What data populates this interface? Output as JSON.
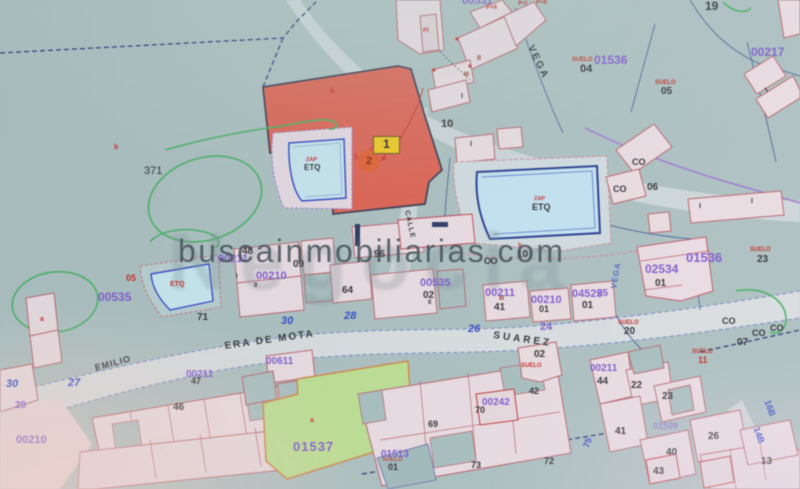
{
  "watermark": {
    "site": "buscainmobiliarias.com",
    "logo": "Negocia"
  },
  "marker": {
    "badge": "1",
    "circle": "2"
  },
  "palette": {
    "black": "#26262a",
    "purple": "#7b50d4",
    "red": "#c9201a",
    "darkred": "#8f2416",
    "blue": "#2340cc",
    "teal_bg": "#a8bec0",
    "red_parcel": "#e25847",
    "pool": "#c0e3f4",
    "green_parcel": "#b9e18a",
    "marker_yellow": "#f2c70c",
    "marker_orange": "#e85420"
  },
  "labels": [
    {
      "t": "ERA DE MOTA",
      "x": 224,
      "y": 342,
      "c": "black",
      "s": 10,
      "r": -8,
      "ls": 2,
      "w": 700
    },
    {
      "t": "SUAREZ",
      "x": 494,
      "y": 331,
      "c": "black",
      "s": 10,
      "r": 8,
      "ls": 3,
      "w": 700
    },
    {
      "t": "EMILIO",
      "x": 94,
      "y": 364,
      "c": "black",
      "s": 9,
      "r": -15,
      "ls": 1,
      "w": 700
    },
    {
      "t": "VEGA",
      "x": 534,
      "y": 44,
      "c": "black",
      "s": 10,
      "r": 64,
      "ls": 2,
      "w": 700
    },
    {
      "t": "CALLE",
      "x": 410,
      "y": 210,
      "c": "black",
      "s": 7,
      "r": 78,
      "ls": 1,
      "w": 700
    },
    {
      "t": "VEGA",
      "x": 610,
      "y": 288,
      "c": "blue",
      "s": 8,
      "r": -80,
      "ls": 1,
      "w": 700,
      "o": 0.75
    },
    {
      "t": "00531",
      "x": 462,
      "y": -4,
      "c": "purple",
      "s": 11,
      "w": 700
    },
    {
      "t": "01536",
      "x": 594,
      "y": 54,
      "c": "purple",
      "s": 12,
      "w": 700
    },
    {
      "t": "00217",
      "x": 751,
      "y": 46,
      "c": "purple",
      "s": 12,
      "w": 700
    },
    {
      "t": "01536",
      "x": 686,
      "y": 251,
      "c": "purple",
      "s": 13,
      "w": 700
    },
    {
      "t": "02534",
      "x": 645,
      "y": 263,
      "c": "purple",
      "s": 12,
      "w": 700
    },
    {
      "t": "04525",
      "x": 572,
      "y": 289,
      "c": "purple",
      "s": 11,
      "w": 700
    },
    {
      "t": "00211",
      "x": 485,
      "y": 288,
      "c": "purple",
      "s": 11,
      "w": 700
    },
    {
      "t": "00210",
      "x": 531,
      "y": 295,
      "c": "purple",
      "s": 11,
      "w": 700
    },
    {
      "t": "24",
      "x": 540,
      "y": 322,
      "c": "purple",
      "s": 11,
      "w": 700
    },
    {
      "t": "00535",
      "x": 420,
      "y": 278,
      "c": "purple",
      "s": 11,
      "w": 700
    },
    {
      "t": "00211",
      "x": 218,
      "y": 254,
      "c": "purple",
      "s": 11,
      "w": 700
    },
    {
      "t": "00210",
      "x": 256,
      "y": 271,
      "c": "purple",
      "s": 11,
      "w": 700
    },
    {
      "t": "00535",
      "x": 98,
      "y": 291,
      "c": "purple",
      "s": 12,
      "w": 700
    },
    {
      "t": "00611",
      "x": 266,
      "y": 357,
      "c": "purple",
      "s": 10,
      "w": 700
    },
    {
      "t": "00211",
      "x": 186,
      "y": 370,
      "c": "purple",
      "s": 10,
      "w": 700
    },
    {
      "t": "00210",
      "x": 16,
      "y": 435,
      "c": "purple",
      "s": 11,
      "w": 700
    },
    {
      "t": "29",
      "x": 15,
      "y": 401,
      "c": "purple",
      "s": 10,
      "w": 700
    },
    {
      "t": "00242",
      "x": 482,
      "y": 398,
      "c": "purple",
      "s": 10,
      "w": 700
    },
    {
      "t": "01513",
      "x": 381,
      "y": 450,
      "c": "purple",
      "s": 10,
      "w": 700
    },
    {
      "t": "01537",
      "x": 293,
      "y": 440,
      "c": "purple",
      "s": 13,
      "w": 700,
      "ls": 1
    },
    {
      "t": "00211",
      "x": 590,
      "y": 364,
      "c": "purple",
      "s": 10,
      "w": 700
    },
    {
      "t": "01509",
      "x": 653,
      "y": 422,
      "c": "purple",
      "s": 9,
      "w": 700,
      "o": 0.6
    },
    {
      "t": "25",
      "x": 597,
      "y": 289,
      "c": "purple",
      "s": 10,
      "w": 700
    },
    {
      "t": "SUELO",
      "x": 572,
      "y": 57,
      "c": "red",
      "s": 6,
      "w": 700
    },
    {
      "t": "04",
      "x": 580,
      "y": 64,
      "c": "black",
      "s": 11,
      "w": 600
    },
    {
      "t": "SUELO",
      "x": 655,
      "y": 80,
      "c": "red",
      "s": 6,
      "w": 700
    },
    {
      "t": "05",
      "x": 661,
      "y": 87,
      "c": "black",
      "s": 10,
      "w": 600
    },
    {
      "t": "SUELO",
      "x": 750,
      "y": 247,
      "c": "red",
      "s": 6,
      "w": 700
    },
    {
      "t": "23",
      "x": 757,
      "y": 255,
      "c": "black",
      "s": 10,
      "w": 600
    },
    {
      "t": "SUELO",
      "x": 618,
      "y": 320,
      "c": "red",
      "s": 6,
      "w": 700
    },
    {
      "t": "20",
      "x": 624,
      "y": 327,
      "c": "black",
      "s": 10,
      "w": 600
    },
    {
      "t": "SUELO",
      "x": 692,
      "y": 349,
      "c": "red",
      "s": 6,
      "w": 700
    },
    {
      "t": "11",
      "x": 698,
      "y": 356,
      "c": "red",
      "s": 9,
      "w": 700
    },
    {
      "t": "SUELO",
      "x": 521,
      "y": 363,
      "c": "red",
      "s": 6,
      "w": 700
    },
    {
      "t": "02",
      "x": 534,
      "y": 350,
      "c": "black",
      "s": 10,
      "w": 600
    },
    {
      "t": "42",
      "x": 529,
      "y": 387,
      "c": "black",
      "s": 9,
      "w": 600
    },
    {
      "t": "SUELO",
      "x": 382,
      "y": 457,
      "c": "red",
      "s": 6,
      "w": 700,
      "o": 0.8
    },
    {
      "t": "05",
      "x": 126,
      "y": 274,
      "c": "red",
      "s": 9,
      "w": 700
    },
    {
      "t": "371",
      "x": 144,
      "y": 166,
      "c": "black",
      "s": 11
    },
    {
      "t": "19",
      "x": 705,
      "y": 0,
      "c": "black",
      "s": 12,
      "w": 600
    },
    {
      "t": "10",
      "x": 441,
      "y": 119,
      "c": "black",
      "s": 11,
      "w": 600
    },
    {
      "t": "10",
      "x": 517,
      "y": 250,
      "c": "black",
      "s": 10,
      "w": 600
    },
    {
      "t": "48",
      "x": 242,
      "y": 247,
      "c": "black",
      "s": 10,
      "w": 600
    },
    {
      "t": "09",
      "x": 293,
      "y": 260,
      "c": "black",
      "s": 10,
      "w": 600
    },
    {
      "t": "96",
      "x": 374,
      "y": 250,
      "c": "black",
      "s": 10,
      "w": 600
    },
    {
      "t": "64",
      "x": 342,
      "y": 286,
      "c": "black",
      "s": 10,
      "w": 600
    },
    {
      "t": "02",
      "x": 423,
      "y": 291,
      "c": "black",
      "s": 10,
      "w": 600
    },
    {
      "t": "41",
      "x": 494,
      "y": 303,
      "c": "black",
      "s": 10,
      "w": 600
    },
    {
      "t": "01",
      "x": 539,
      "y": 305,
      "c": "black",
      "s": 9,
      "w": 600
    },
    {
      "t": "01",
      "x": 582,
      "y": 301,
      "c": "black",
      "s": 10,
      "w": 600
    },
    {
      "t": "01",
      "x": 655,
      "y": 279,
      "c": "black",
      "s": 10,
      "w": 600
    },
    {
      "t": "06",
      "x": 647,
      "y": 183,
      "c": "black",
      "s": 10,
      "w": 600
    },
    {
      "t": "CO",
      "x": 632,
      "y": 158,
      "c": "black",
      "s": 9,
      "w": 700
    },
    {
      "t": "CO",
      "x": 613,
      "y": 185,
      "c": "black",
      "s": 9,
      "w": 700
    },
    {
      "t": "CO",
      "x": 484,
      "y": 257,
      "c": "black",
      "s": 9,
      "w": 700
    },
    {
      "t": "CO",
      "x": 722,
      "y": 317,
      "c": "black",
      "s": 9,
      "w": 700
    },
    {
      "t": "CO",
      "x": 752,
      "y": 329,
      "c": "black",
      "s": 9,
      "w": 700
    },
    {
      "t": "CO",
      "x": 770,
      "y": 324,
      "c": "black",
      "s": 9,
      "w": 700
    },
    {
      "t": "07",
      "x": 737,
      "y": 338,
      "c": "black",
      "s": 10,
      "w": 600
    },
    {
      "t": "71",
      "x": 197,
      "y": 313,
      "c": "black",
      "s": 10,
      "w": 600
    },
    {
      "t": "46",
      "x": 173,
      "y": 403,
      "c": "black",
      "s": 10,
      "w": 600
    },
    {
      "t": "47",
      "x": 191,
      "y": 377,
      "c": "black",
      "s": 9,
      "w": 600
    },
    {
      "t": "70",
      "x": 475,
      "y": 406,
      "c": "black",
      "s": 9,
      "w": 600
    },
    {
      "t": "01",
      "x": 388,
      "y": 463,
      "c": "black",
      "s": 9,
      "w": 600
    },
    {
      "t": "44",
      "x": 597,
      "y": 377,
      "c": "black",
      "s": 10,
      "w": 600
    },
    {
      "t": "22",
      "x": 631,
      "y": 381,
      "c": "black",
      "s": 10,
      "w": 600
    },
    {
      "t": "23",
      "x": 662,
      "y": 392,
      "c": "black",
      "s": 10,
      "w": 600
    },
    {
      "t": "41",
      "x": 615,
      "y": 427,
      "c": "black",
      "s": 10,
      "w": 600
    },
    {
      "t": "26",
      "x": 708,
      "y": 432,
      "c": "black",
      "s": 10,
      "w": 600
    },
    {
      "t": "40",
      "x": 666,
      "y": 448,
      "c": "black",
      "s": 10,
      "w": 600
    },
    {
      "t": "43",
      "x": 653,
      "y": 467,
      "c": "black",
      "s": 10,
      "w": 600
    },
    {
      "t": "13",
      "x": 761,
      "y": 457,
      "c": "black",
      "s": 10,
      "w": 600
    },
    {
      "t": "69",
      "x": 428,
      "y": 420,
      "c": "black",
      "s": 9,
      "w": 600
    },
    {
      "t": "73",
      "x": 471,
      "y": 461,
      "c": "black",
      "s": 9,
      "w": 600
    },
    {
      "t": "72",
      "x": 544,
      "y": 457,
      "c": "black",
      "s": 9,
      "w": 600
    },
    {
      "t": "30",
      "x": 281,
      "y": 316,
      "c": "blue",
      "s": 11,
      "w": 700,
      "i": 1
    },
    {
      "t": "28",
      "x": 344,
      "y": 311,
      "c": "blue",
      "s": 11,
      "w": 700,
      "i": 1
    },
    {
      "t": "26",
      "x": 468,
      "y": 324,
      "c": "blue",
      "s": 11,
      "w": 700,
      "i": 1
    },
    {
      "t": "27",
      "x": 68,
      "y": 378,
      "c": "blue",
      "s": 11,
      "w": 700,
      "i": 1
    },
    {
      "t": "30",
      "x": 6,
      "y": 379,
      "c": "blue",
      "s": 11,
      "w": 700,
      "i": 1
    },
    {
      "t": "75",
      "x": 582,
      "y": 446,
      "c": "blue",
      "s": 9,
      "w": 700,
      "r": -70
    },
    {
      "t": "16B",
      "x": 771,
      "y": 399,
      "c": "blue",
      "s": 9,
      "w": 700,
      "r": 70
    },
    {
      "t": "14B",
      "x": 760,
      "y": 426,
      "c": "blue",
      "s": 9,
      "w": 700,
      "r": 70
    },
    {
      "t": "b",
      "x": 114,
      "y": 144,
      "c": "red",
      "s": 7,
      "w": 700
    },
    {
      "t": "b",
      "x": 330,
      "y": 88,
      "c": "red",
      "s": 7,
      "w": 700
    },
    {
      "t": "a",
      "x": 382,
      "y": 155,
      "c": "red",
      "s": 7,
      "w": 700
    },
    {
      "t": "1",
      "x": 354,
      "y": 154,
      "c": "red",
      "s": 7,
      "w": 700
    },
    {
      "t": "a",
      "x": 310,
      "y": 417,
      "c": "red",
      "s": 7,
      "w": 700
    },
    {
      "t": "a",
      "x": 40,
      "y": 316,
      "c": "red",
      "s": 7,
      "w": 700
    },
    {
      "t": "b",
      "x": 518,
      "y": 243,
      "c": "red",
      "s": 6,
      "w": 700
    },
    {
      "t": "P+II",
      "x": 486,
      "y": 5,
      "c": "red",
      "s": 6,
      "w": 700
    },
    {
      "t": "P+I",
      "x": 518,
      "y": 1,
      "c": "red",
      "s": 6,
      "w": 700
    },
    {
      "t": "P+II",
      "x": 536,
      "y": 0,
      "c": "red",
      "s": 6,
      "w": 700
    },
    {
      "t": "PI",
      "x": 423,
      "y": 28,
      "c": "red",
      "s": 6,
      "w": 700
    },
    {
      "t": "II",
      "x": 477,
      "y": 55,
      "c": "darkred",
      "s": 7,
      "w": 700
    },
    {
      "t": "III",
      "x": 464,
      "y": 72,
      "c": "darkred",
      "s": 6,
      "w": 700
    },
    {
      "t": "I",
      "x": 461,
      "y": 93,
      "c": "black",
      "s": 7,
      "w": 600
    },
    {
      "t": "I",
      "x": 470,
      "y": 141,
      "c": "black",
      "s": 7,
      "w": 600
    },
    {
      "t": "I",
      "x": 699,
      "y": 203,
      "c": "black",
      "s": 7,
      "w": 600
    },
    {
      "t": "I",
      "x": 751,
      "y": 198,
      "c": "black",
      "s": 7,
      "w": 600
    },
    {
      "t": "I",
      "x": 764,
      "y": 88,
      "c": "black",
      "s": 7,
      "w": 600,
      "r": -35
    },
    {
      "t": "II",
      "x": 254,
      "y": 283,
      "c": "black",
      "s": 6,
      "w": 600
    },
    {
      "t": "I",
      "x": 236,
      "y": 274,
      "c": "black",
      "s": 6,
      "w": 600
    },
    {
      "t": "II",
      "x": 428,
      "y": 300,
      "c": "black",
      "s": 6,
      "w": 600
    },
    {
      "t": "III",
      "x": 499,
      "y": 296,
      "c": "darkred",
      "s": 6,
      "w": 700
    },
    {
      "t": "ZAP",
      "x": 306,
      "y": 158,
      "c": "red",
      "s": 5.5,
      "w": 700
    },
    {
      "t": "ETQ",
      "x": 304,
      "y": 164,
      "c": "black",
      "s": 8,
      "w": 700
    },
    {
      "t": "ZAP",
      "x": 534,
      "y": 197,
      "c": "red",
      "s": 5.5,
      "w": 700
    },
    {
      "t": "ETQ",
      "x": 532,
      "y": 203,
      "c": "black",
      "s": 9,
      "w": 700
    },
    {
      "t": "ETQ",
      "x": 170,
      "y": 281,
      "c": "red",
      "s": 7,
      "w": 700
    }
  ]
}
